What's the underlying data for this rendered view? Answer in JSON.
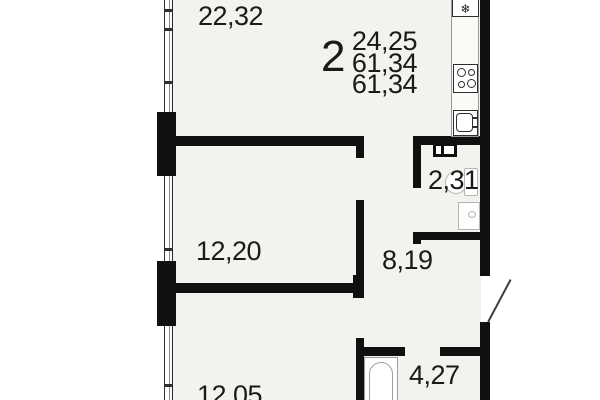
{
  "colors": {
    "floor": "#f3f2ee",
    "wall": "#101010",
    "text": "#1a1a1a",
    "fixture": "#b5b5b2"
  },
  "apartment_info": {
    "rooms_count": "2",
    "living_area": "24,25",
    "total_area": "61,34",
    "total_area_2": "61,34"
  },
  "rooms": {
    "living": {
      "area": "22,32"
    },
    "bedroom1": {
      "area": "12,20"
    },
    "bedroom2": {
      "area": "12,05"
    },
    "hallway": {
      "area": "8,19"
    },
    "wc": {
      "area": "2,31"
    },
    "bathroom": {
      "area": "4,27"
    }
  },
  "icons": {
    "fridge_glyph": "❄"
  }
}
